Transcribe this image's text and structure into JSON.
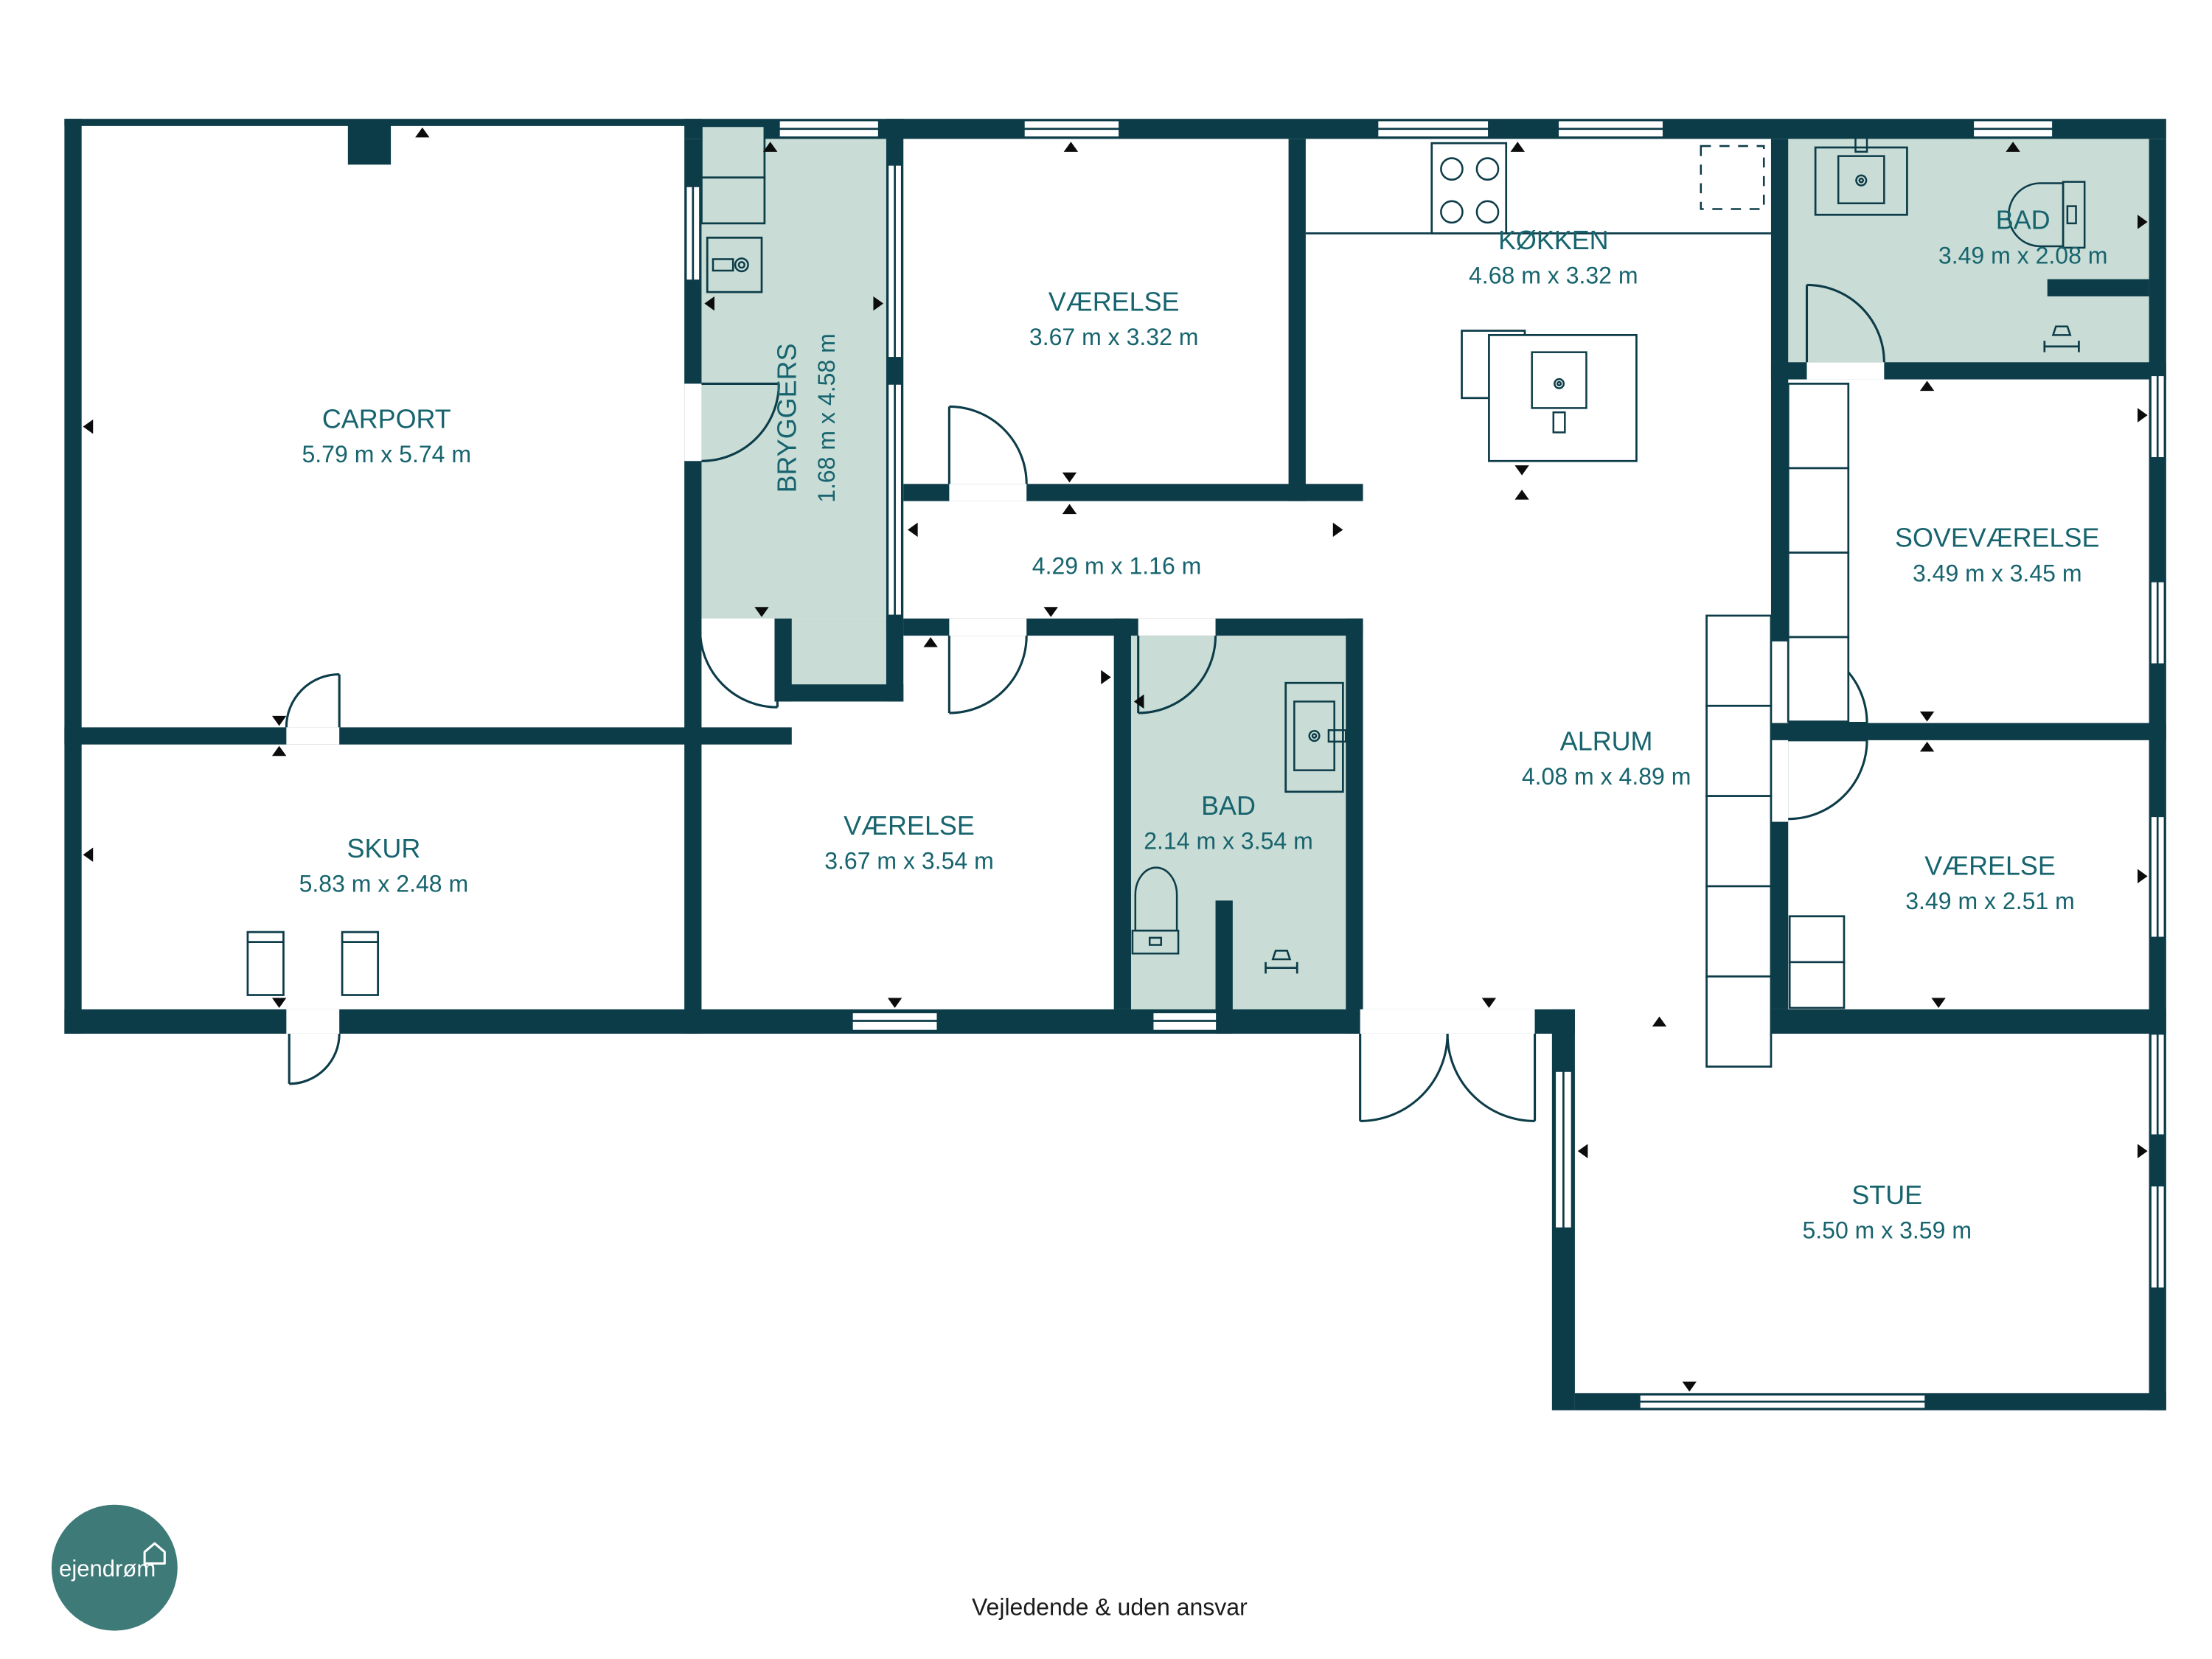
{
  "plan": {
    "rooms": [
      {
        "id": "carport",
        "name": "CARPORT",
        "dims": "5.79 m x 5.74 m"
      },
      {
        "id": "skur",
        "name": "SKUR",
        "dims": "5.83 m x 2.48 m"
      },
      {
        "id": "bryggers",
        "name": "BRYGGERS",
        "dims": "1.68 m x 4.58 m"
      },
      {
        "id": "vaerelse-top",
        "name": "VÆRELSE",
        "dims": "3.67 m x 3.32 m"
      },
      {
        "id": "koekken",
        "name": "KØKKEN",
        "dims": "4.68 m x 3.32 m"
      },
      {
        "id": "gang",
        "name": "",
        "dims": "4.29 m x 1.16 m"
      },
      {
        "id": "vaerelse-mid",
        "name": "VÆRELSE",
        "dims": "3.67 m x 3.54 m"
      },
      {
        "id": "bad-mid",
        "name": "BAD",
        "dims": "2.14 m x 3.54 m"
      },
      {
        "id": "alrum",
        "name": "ALRUM",
        "dims": "4.08 m x 4.89 m"
      },
      {
        "id": "bad-top",
        "name": "BAD",
        "dims": "3.49 m x 2.08 m"
      },
      {
        "id": "sovevaerelse",
        "name": "SOVEVÆRELSE",
        "dims": "3.49 m x 3.45 m"
      },
      {
        "id": "vaerelse-right",
        "name": "VÆRELSE",
        "dims": "3.49 m x 2.51 m"
      },
      {
        "id": "stue",
        "name": "STUE",
        "dims": "5.50 m x 3.59 m"
      }
    ],
    "footer": {
      "disclaimer": "Vejledende & uden ansvar"
    },
    "logo": {
      "text": "ejendrøm"
    },
    "colors": {
      "wall": "#0d3c49",
      "wet_room": "#c9ddd6",
      "label": "#17646e",
      "logo_bg": "#3e7a78",
      "footer_text": "#1b1b1b",
      "background": "#ffffff"
    }
  }
}
